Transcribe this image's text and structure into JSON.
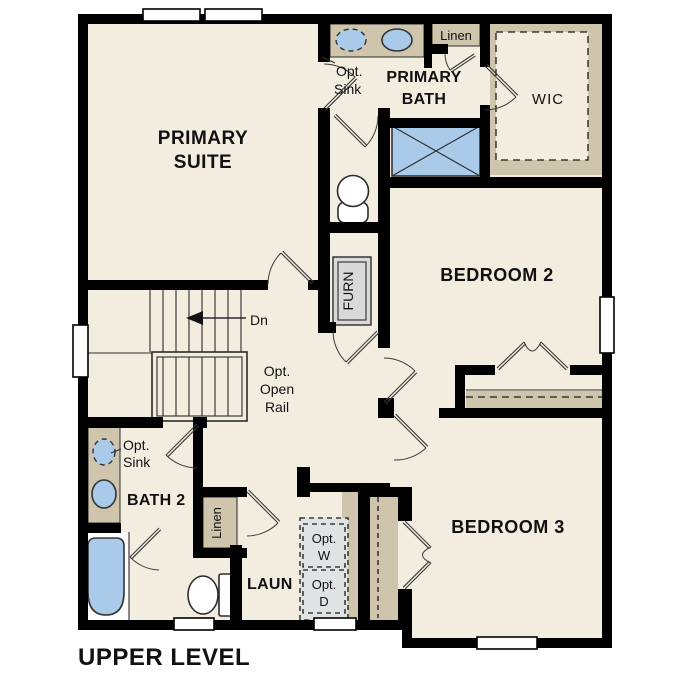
{
  "title": "UPPER LEVEL",
  "colors": {
    "floor": "#f3ede0",
    "accent_tan": "#cfc4ac",
    "fixture_blue": "#a9cae9",
    "washer_dryer_gray": "#dfe3e3",
    "furnace_gray": "#d9d9d9",
    "wall": "#000000"
  },
  "rooms": {
    "primary_suite": {
      "label_line1": "PRIMARY",
      "label_line2": "SUITE"
    },
    "primary_bath": {
      "label_line1": "PRIMARY",
      "label_line2": "BATH"
    },
    "wic": {
      "label": "WIC"
    },
    "bedroom2": {
      "label": "BEDROOM 2"
    },
    "bedroom3": {
      "label": "BEDROOM 3"
    },
    "bath2": {
      "label": "BATH 2"
    },
    "laundry": {
      "label": "LAUN"
    }
  },
  "annotations": {
    "linen_upper": "Linen",
    "linen_lower": "Linen",
    "furnace": "FURN",
    "stairs_down": "Dn",
    "opt_open_rail": [
      "Opt.",
      "Open",
      "Rail"
    ],
    "opt_sink_primary": [
      "Opt.",
      "Sink"
    ],
    "opt_sink_bath2": [
      "Opt.",
      "Sink"
    ],
    "opt_washer": [
      "Opt.",
      "W"
    ],
    "opt_dryer": [
      "Opt.",
      "D"
    ]
  }
}
